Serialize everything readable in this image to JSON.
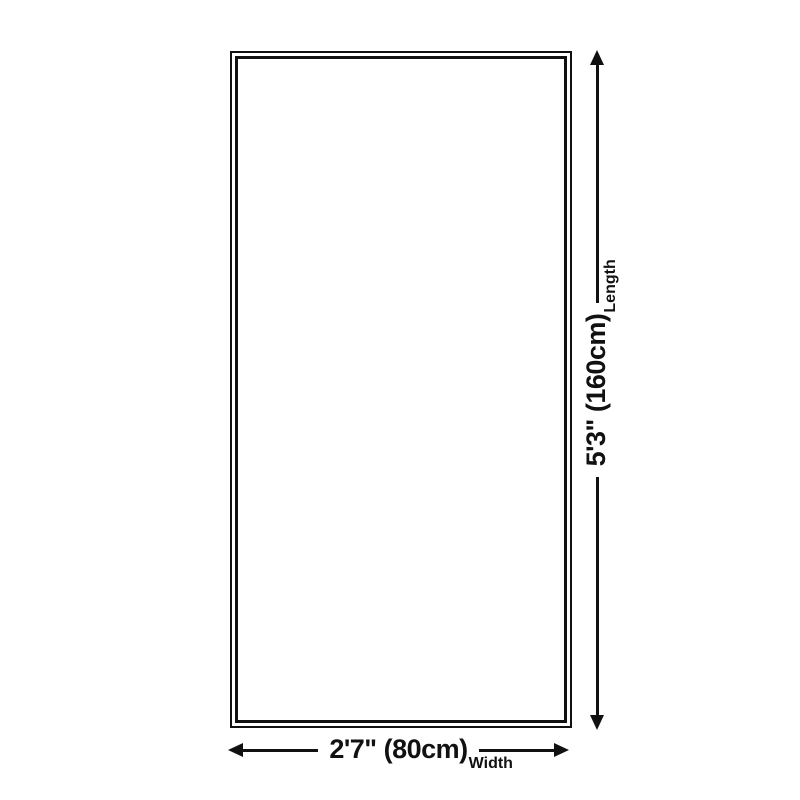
{
  "page": {
    "background_color": "#ffffff",
    "ink_color": "#111111"
  },
  "rug_diagram": {
    "length": {
      "value": "5'3\" (160cm)",
      "label": "Length"
    },
    "width": {
      "value": "2'7\" (80cm)",
      "label": "Width"
    }
  },
  "icons": {
    "up": "arrow-up-icon",
    "down": "arrow-down-icon",
    "left": "arrow-left-icon",
    "right": "arrow-right-icon"
  }
}
